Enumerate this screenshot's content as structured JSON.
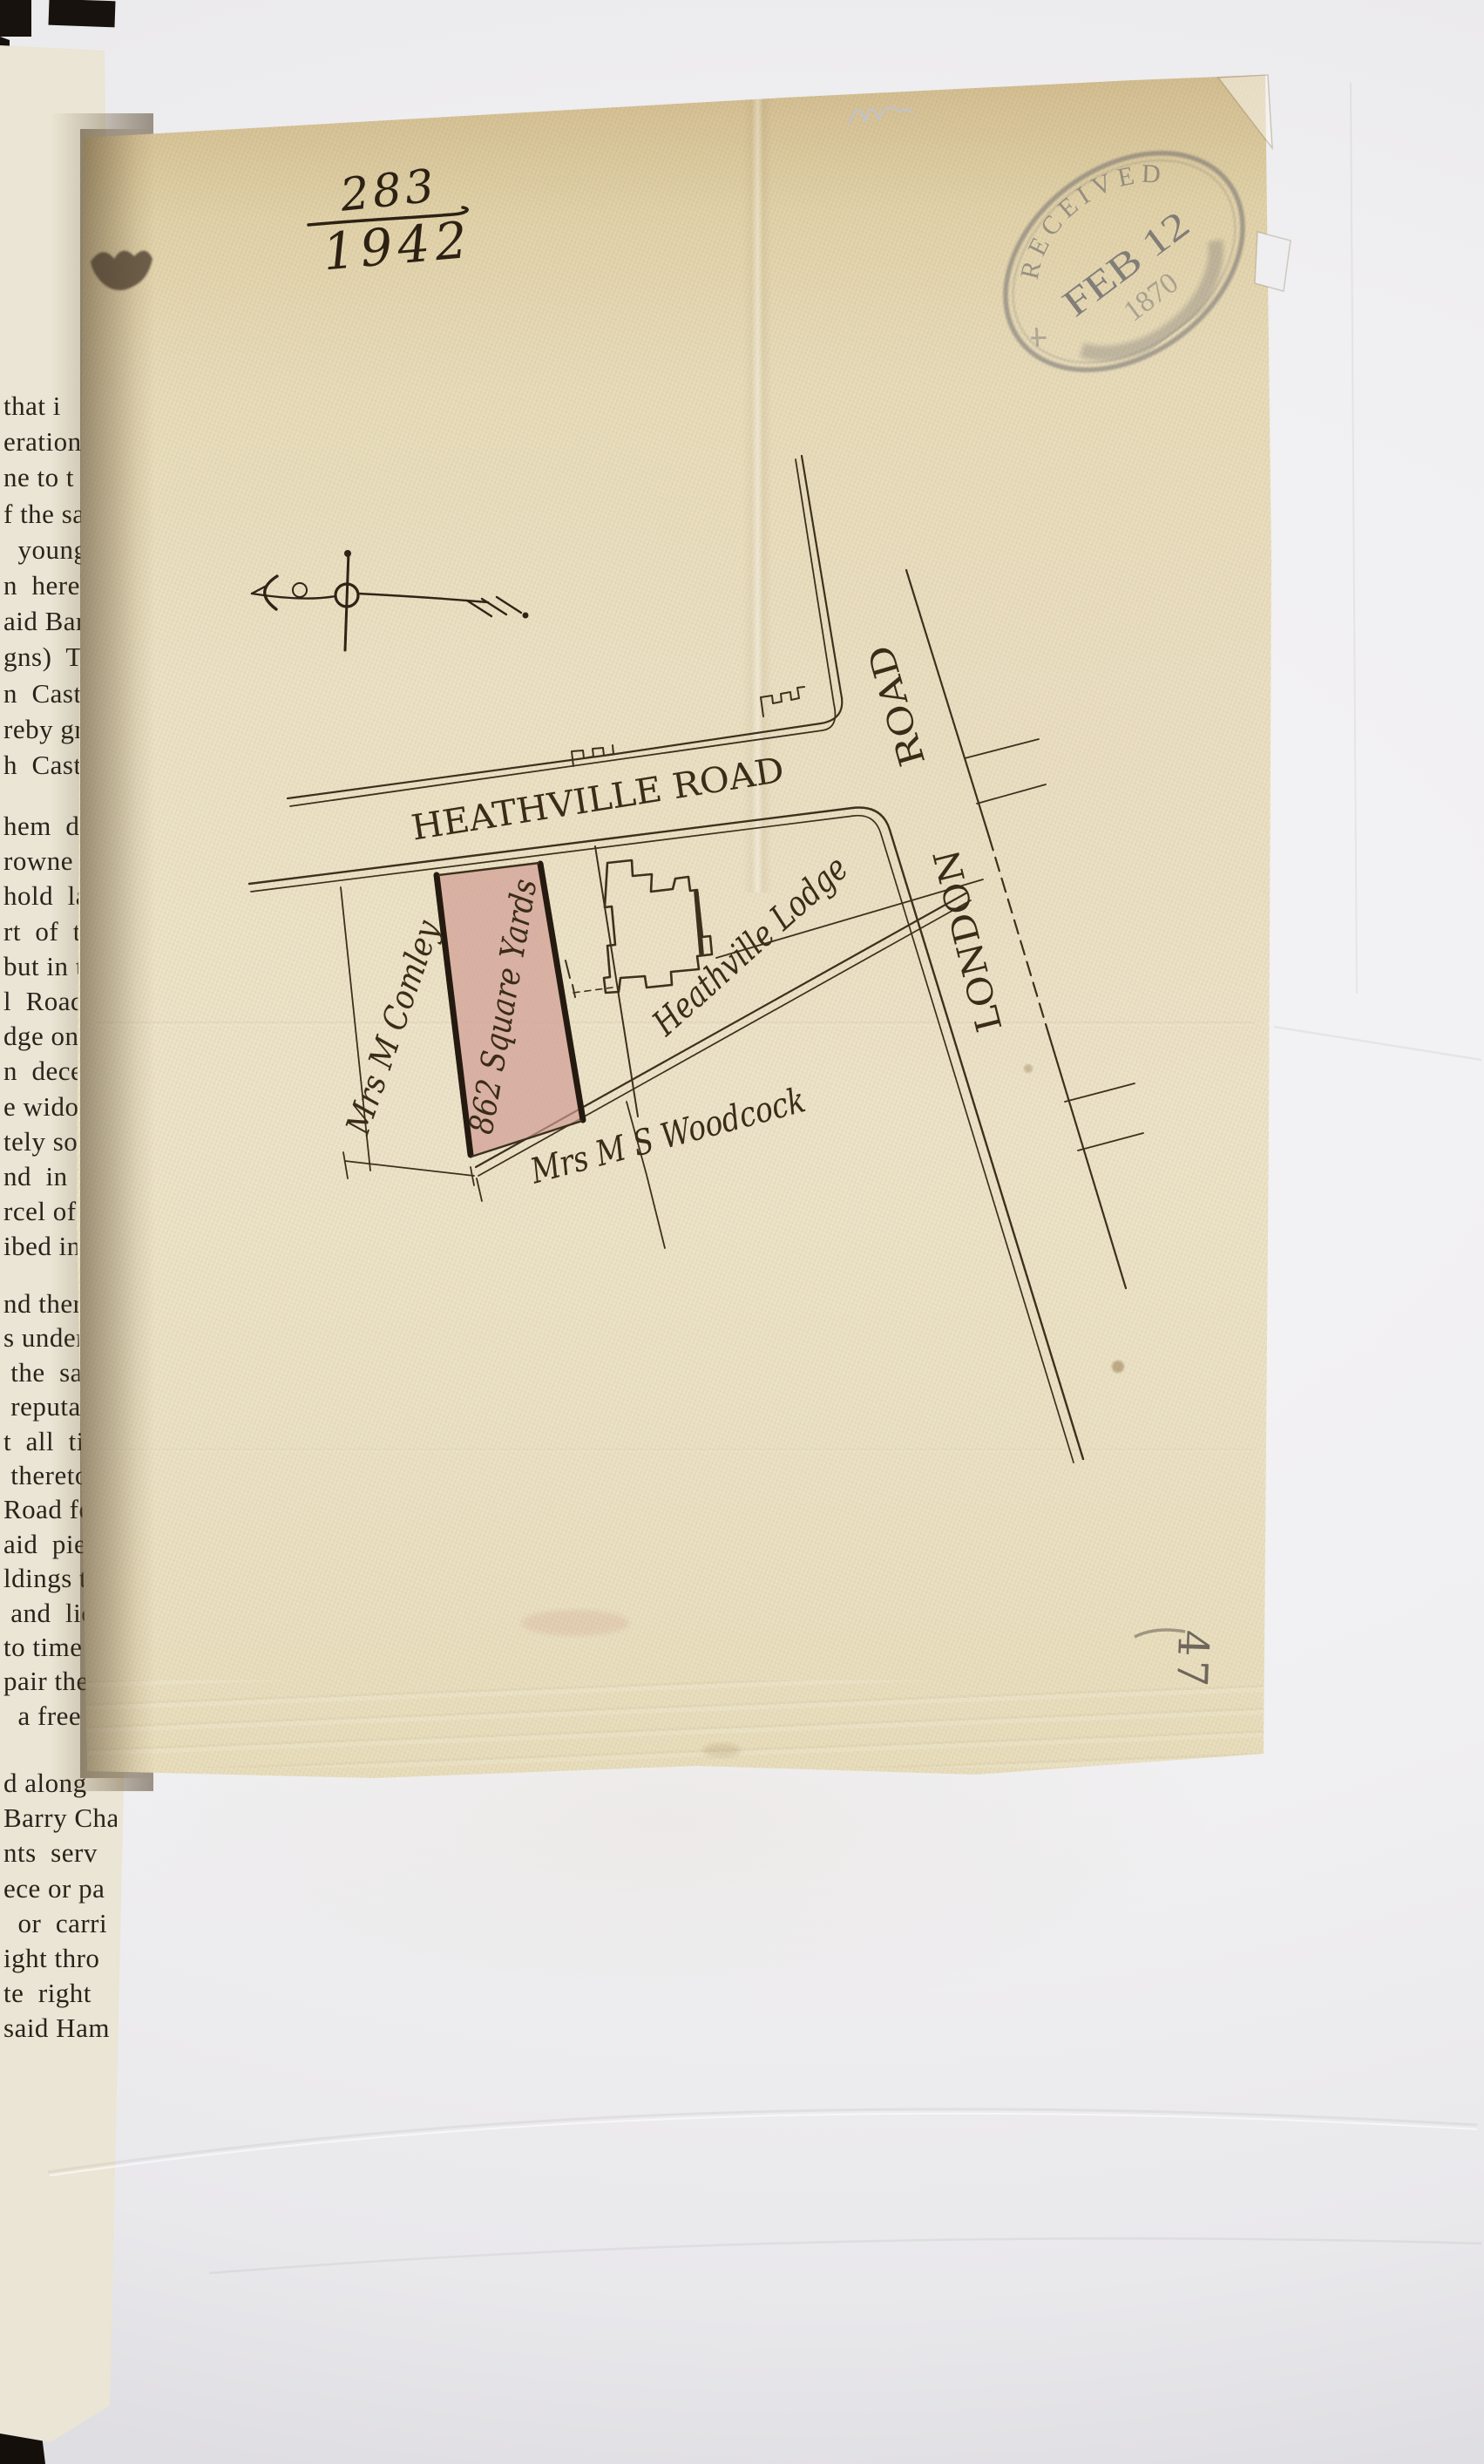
{
  "reference": {
    "numerator": "283",
    "denominator": "1942"
  },
  "stamp": {
    "arc_top": "RECEIVED",
    "date": "FEB 12",
    "year": "1870"
  },
  "map": {
    "roads": {
      "heathville": "HEATHVILLE  ROAD",
      "london_word": "LONDON",
      "road_word": "ROAD"
    },
    "plot": {
      "area_label": "862 Square Yards",
      "fill_color": "#d09b93"
    },
    "owners": {
      "west": "Mrs M Comley",
      "south": "Mrs M S Woodcock"
    },
    "lodge_label": "Heathville Lodge"
  },
  "pencil_note": "47",
  "colors": {
    "paper": "#e8dcba",
    "ink": "#3d301d",
    "stamp_ink": "#565662",
    "plot_pink": "#d09b93"
  },
  "book_page": {
    "line_groups": [
      [
        "that i",
        "eration",
        "ne to t",
        "f the sa",
        "  young",
        "n  hereb",
        "aid Barr",
        "gns)  Th",
        "n  Castre",
        "reby gra",
        "h  Castr"
      ],
      [
        "hem  do",
        "rowne h",
        "hold  lan",
        "rt  of  t",
        "but in t",
        "l  Road",
        "dge on t",
        "n  deceas",
        "e widow",
        "tely sold",
        "nd  in  t",
        "rcel of la",
        "ibed in t"
      ],
      [
        "nd there",
        "s under t",
        " the  sa",
        " reputati",
        "t  all  tim",
        " thereto t",
        "Road for t",
        "aid  piece",
        "ldings to",
        " and  lice",
        "to time w",
        "pair the s",
        "  a free"
      ],
      [
        "d along",
        "Barry Cha",
        "nts  serv",
        "ece or pa",
        "  or  carri",
        "ight thro",
        "te  right",
        "said Ham"
      ]
    ]
  }
}
